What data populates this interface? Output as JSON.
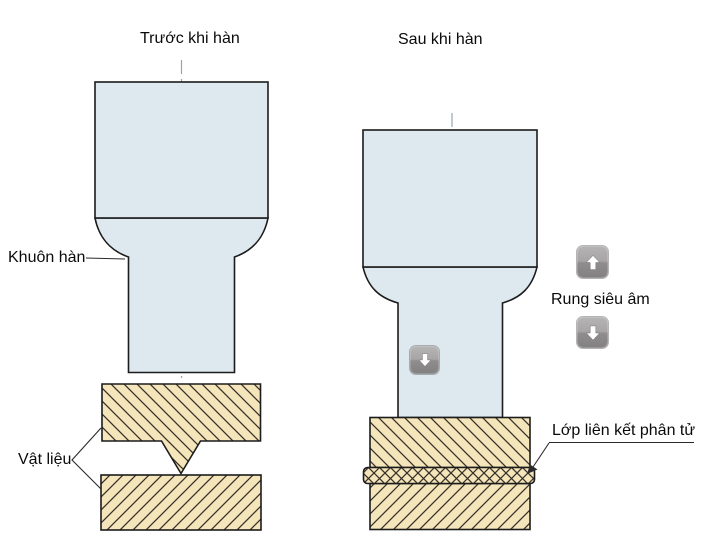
{
  "panels": {
    "before": {
      "title": "Trước khi hàn"
    },
    "after": {
      "title": "Sau khi hàn"
    }
  },
  "labels": {
    "horn": "Khuôn hàn",
    "material": "Vật liệu",
    "vibration": "Rung siêu âm",
    "bond_layer": "Lớp liên kết phân tử"
  },
  "icons": {
    "up": "arrow-up",
    "down": "arrow-down"
  },
  "colors": {
    "horn_fill": "#dde9ef",
    "material_fill": "#f5e5ba",
    "outline": "#1c1c1c",
    "hatch": "#39322a",
    "centerline": "#97a6ad",
    "button_top": "#b6b4b4",
    "button_bottom": "#828080",
    "arrow": "#ffffff"
  }
}
